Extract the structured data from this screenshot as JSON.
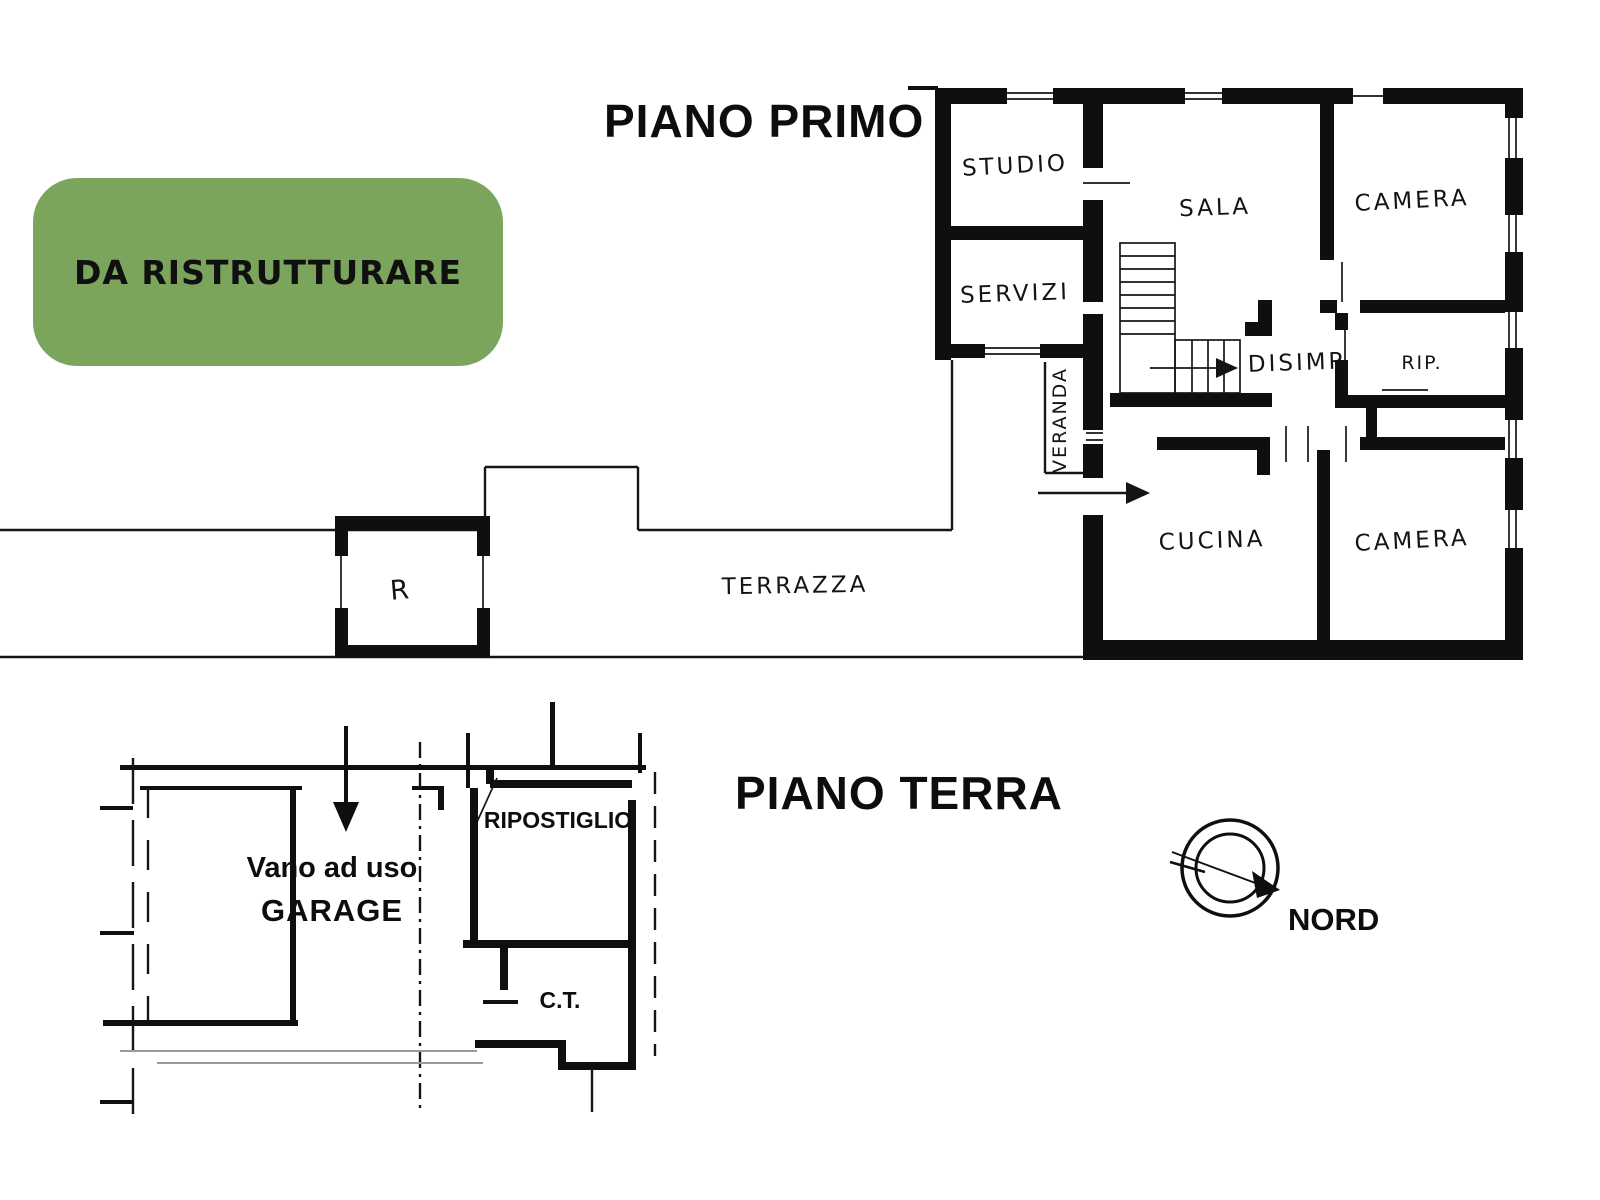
{
  "badge": {
    "label": "DA RISTRUTTURARE",
    "background_color": "#7ba55c",
    "text_color": "#101010"
  },
  "first_floor": {
    "title": "PIANO PRIMO",
    "rooms": {
      "studio": "STUDIO",
      "servizi": "SERVIZI",
      "sala": "SALA",
      "camera_top": "CAMERA",
      "disimp": "DISIMP.",
      "rip": "RIP.",
      "veranda": "VERANDA",
      "cucina": "CUCINA",
      "camera_bottom": "CAMERA",
      "terrazza": "TERRAZZA",
      "r": "R"
    }
  },
  "ground_floor": {
    "title": "PIANO TERRA",
    "rooms": {
      "ripostiglio": "RIPOSTIGLIO",
      "garage_line1": "Vano ad uso",
      "garage_line2": "GARAGE",
      "ct": "C.T."
    }
  },
  "compass": {
    "label": "NORD"
  },
  "drawing": {
    "ink_color": "#0f0f0f",
    "paper_color": "#ffffff"
  }
}
